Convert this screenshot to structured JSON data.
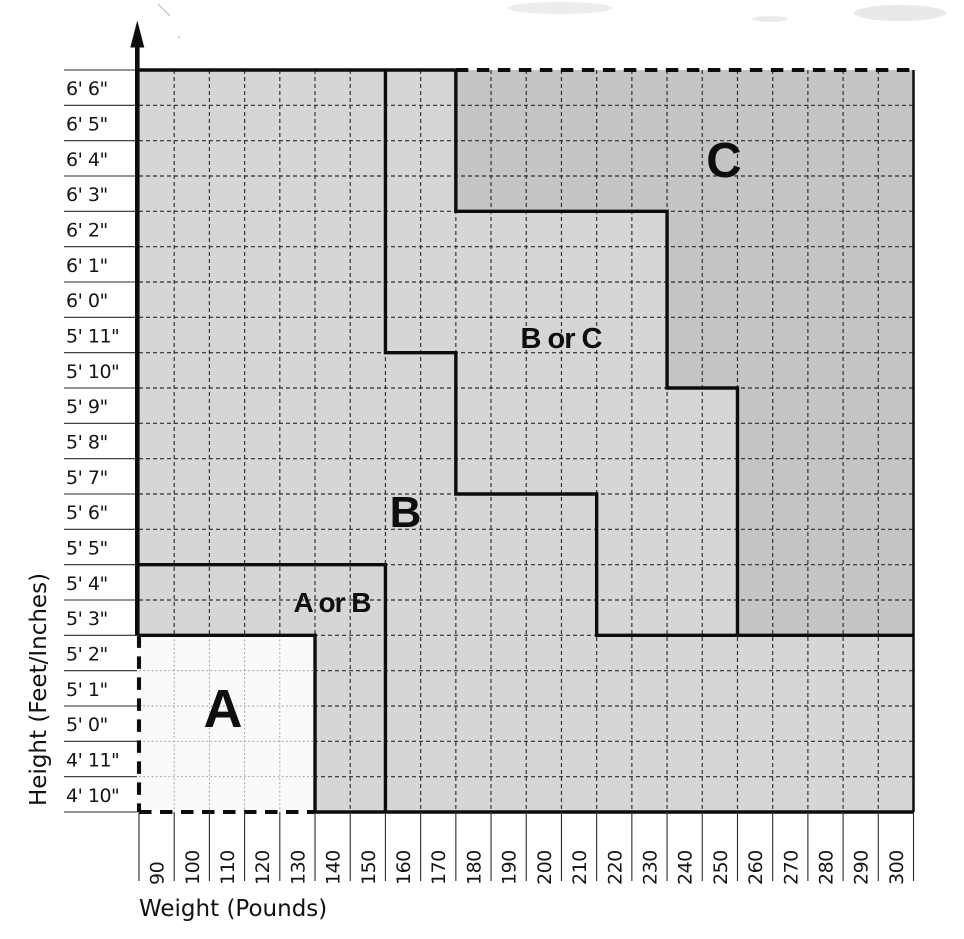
{
  "chart_data": {
    "type": "area",
    "title": "",
    "xlabel": "Weight (Pounds)",
    "ylabel": "Height (Feet/Inches)",
    "grid": "on, dashed, one cell per 10 lb x 1 inch",
    "legend_position": "none (zones labeled in-plot)",
    "x_axis": {
      "label": "Weight (Pounds)",
      "tick_labels": [
        "90",
        "100",
        "110",
        "120",
        "130",
        "140",
        "150",
        "160",
        "170",
        "180",
        "190",
        "200",
        "210",
        "220",
        "230",
        "240",
        "250",
        "260",
        "270",
        "280",
        "290",
        "300"
      ],
      "tick_style": "labels rotated 90 degrees CCW below axis"
    },
    "y_axis": {
      "label": "Height (Feet/Inches)",
      "tick_labels_top_to_bottom": [
        "6' 6\"",
        "6' 5\"",
        "6' 4\"",
        "6' 3\"",
        "6' 2\"",
        "6' 1\"",
        "6' 0\"",
        "5' 11\"",
        "5' 10\"",
        "5' 9\"",
        "5' 8\"",
        "5' 7\"",
        "5' 6\"",
        "5' 5\"",
        "5' 4\"",
        "5' 3\"",
        "5' 2\"",
        "5' 1\"",
        "5' 0\"",
        "4' 11\"",
        "4' 10\""
      ],
      "arrow": "up arrow at top of y-axis"
    },
    "zones": [
      {
        "id": "a",
        "label": "A",
        "fill": "#fafaf8",
        "weights": "90-130 lb",
        "heights": "4' 10\" - 5' 2\"",
        "note": "left and bottom borders dashed"
      },
      {
        "id": "a_or_b",
        "label": "A or B",
        "fill": "#d6d7d4",
        "weights": "90-150 lb",
        "heights": "4' 10\" - 5' 4\" excluding zone A"
      },
      {
        "id": "b",
        "label": "B",
        "fill": "#d6d7d4",
        "right_boundary_steps": [
          {
            "heights": "5' 11\" - 6' 6\"",
            "boundary_weight": 160
          },
          {
            "heights": "5' 7\" - 5' 10\"",
            "boundary_weight": 180
          },
          {
            "heights": "5' 3\" - 5' 6\"",
            "boundary_weight": 220
          },
          {
            "heights": "4' 10\" - 5' 2\"",
            "boundary_weight": 300
          }
        ]
      },
      {
        "id": "b_or_c",
        "label": "B or C",
        "fill": "#d6d7d4",
        "between": "zone B boundary and zone C boundary"
      },
      {
        "id": "c",
        "label": "C",
        "fill": "#c4c6c3",
        "left_boundary_steps": [
          {
            "heights": "6' 3\" - 6' 6\"",
            "boundary_weight": 180
          },
          {
            "heights": "5' 10\" - 6' 2\"",
            "boundary_weight": 240
          },
          {
            "heights": "5' 3\" - 5' 9\"",
            "boundary_weight": 260
          }
        ],
        "note": "top border dashed; occupies top-right corner down to 5' 3\""
      }
    ],
    "regions_grid": [
      {
        "id": "base-light",
        "fill": "#d6d7d4",
        "points": [
          [
            0,
            0
          ],
          [
            22,
            0
          ],
          [
            22,
            21
          ],
          [
            0,
            21
          ]
        ]
      },
      {
        "id": "c",
        "fill": "#c4c6c3",
        "points": [
          [
            9,
            0
          ],
          [
            22,
            0
          ],
          [
            22,
            16
          ],
          [
            17,
            16
          ],
          [
            17,
            9
          ],
          [
            15,
            9
          ],
          [
            15,
            4
          ],
          [
            9,
            4
          ]
        ]
      },
      {
        "id": "a",
        "fill": "#fafaf8",
        "points": [
          [
            0,
            16
          ],
          [
            5,
            16
          ],
          [
            5,
            21
          ],
          [
            0,
            21
          ]
        ]
      }
    ],
    "boundaries_grid": [
      {
        "id": "top-border-solid",
        "style": "solid",
        "points": [
          [
            0,
            0
          ],
          [
            9,
            0
          ]
        ]
      },
      {
        "id": "top-border-dashed",
        "style": "dashed",
        "points": [
          [
            9,
            0
          ],
          [
            22,
            0
          ]
        ]
      },
      {
        "id": "right-border",
        "style": "solid-thin",
        "points": [
          [
            22,
            0
          ],
          [
            22,
            21
          ]
        ]
      },
      {
        "id": "bottom-axis",
        "style": "solid",
        "points": [
          [
            5,
            21
          ],
          [
            22,
            21
          ]
        ]
      },
      {
        "id": "b-boundary",
        "style": "solid",
        "points": [
          [
            7,
            0
          ],
          [
            7,
            8
          ],
          [
            9,
            8
          ],
          [
            9,
            12
          ],
          [
            13,
            12
          ],
          [
            13,
            16
          ],
          [
            22,
            16
          ]
        ]
      },
      {
        "id": "c-boundary",
        "style": "solid",
        "points": [
          [
            9,
            0
          ],
          [
            9,
            4
          ],
          [
            15,
            4
          ],
          [
            15,
            9
          ],
          [
            17,
            9
          ],
          [
            17,
            16
          ]
        ]
      },
      {
        "id": "a-or-b-boundary",
        "style": "solid",
        "points": [
          [
            0,
            14
          ],
          [
            7,
            14
          ],
          [
            7,
            21
          ]
        ]
      },
      {
        "id": "a-boundary",
        "style": "solid",
        "points": [
          [
            0,
            16
          ],
          [
            5,
            16
          ],
          [
            5,
            21
          ]
        ]
      },
      {
        "id": "a-left-dashed",
        "style": "dashed",
        "points": [
          [
            0,
            16
          ],
          [
            0,
            21
          ]
        ]
      },
      {
        "id": "a-bottom-dashed",
        "style": "dashed",
        "points": [
          [
            0,
            21
          ],
          [
            5,
            21
          ]
        ]
      }
    ]
  }
}
